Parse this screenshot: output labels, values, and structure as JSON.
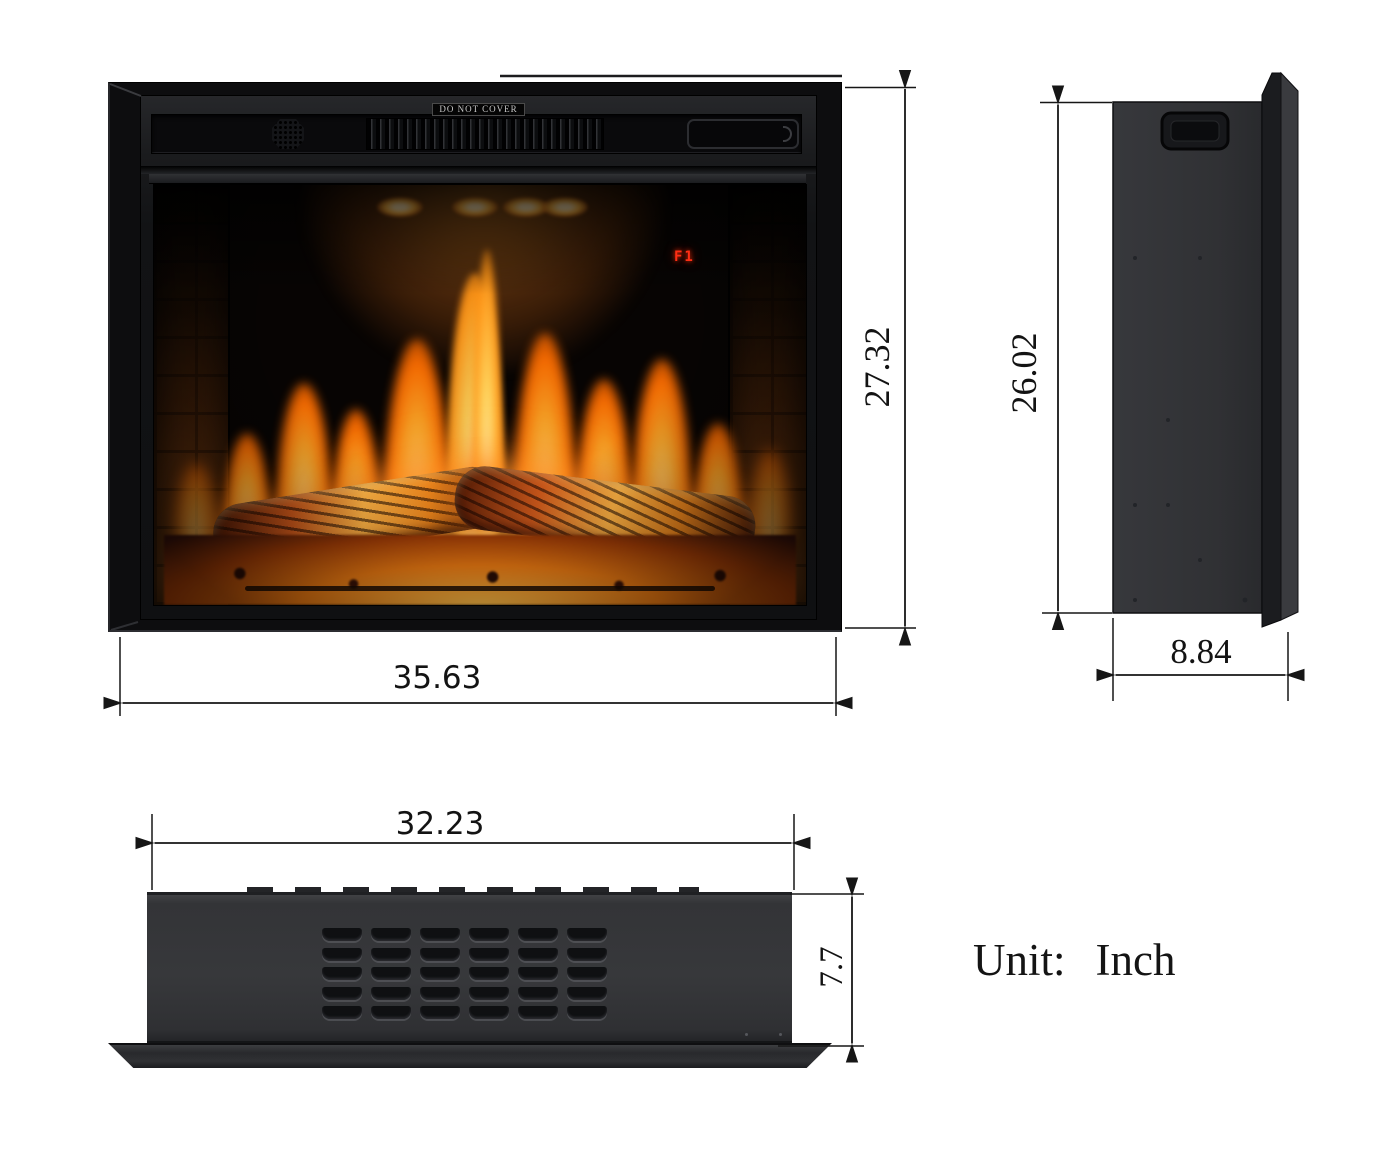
{
  "unit_note": {
    "label": "Unit:",
    "value": "Inch"
  },
  "views": {
    "front": {
      "warning_label": "DO NOT COVER",
      "led_display": "F1",
      "width_in": "35.63",
      "height_in": "27.32"
    },
    "side": {
      "height_in": "26.02",
      "depth_in": "8.84"
    },
    "top": {
      "width_in": "32.23",
      "depth_in": "7.7"
    }
  },
  "colors": {
    "background": "#ffffff",
    "dimension_line": "#161616",
    "product_black": "#1b1c1e",
    "panel_gray": "#333437",
    "flame_orange": "#ff8c1a",
    "flame_yellow": "#ffd27a",
    "ember_red": "#b2410a",
    "led_red": "#ff2e14",
    "label_color": "#131313"
  }
}
